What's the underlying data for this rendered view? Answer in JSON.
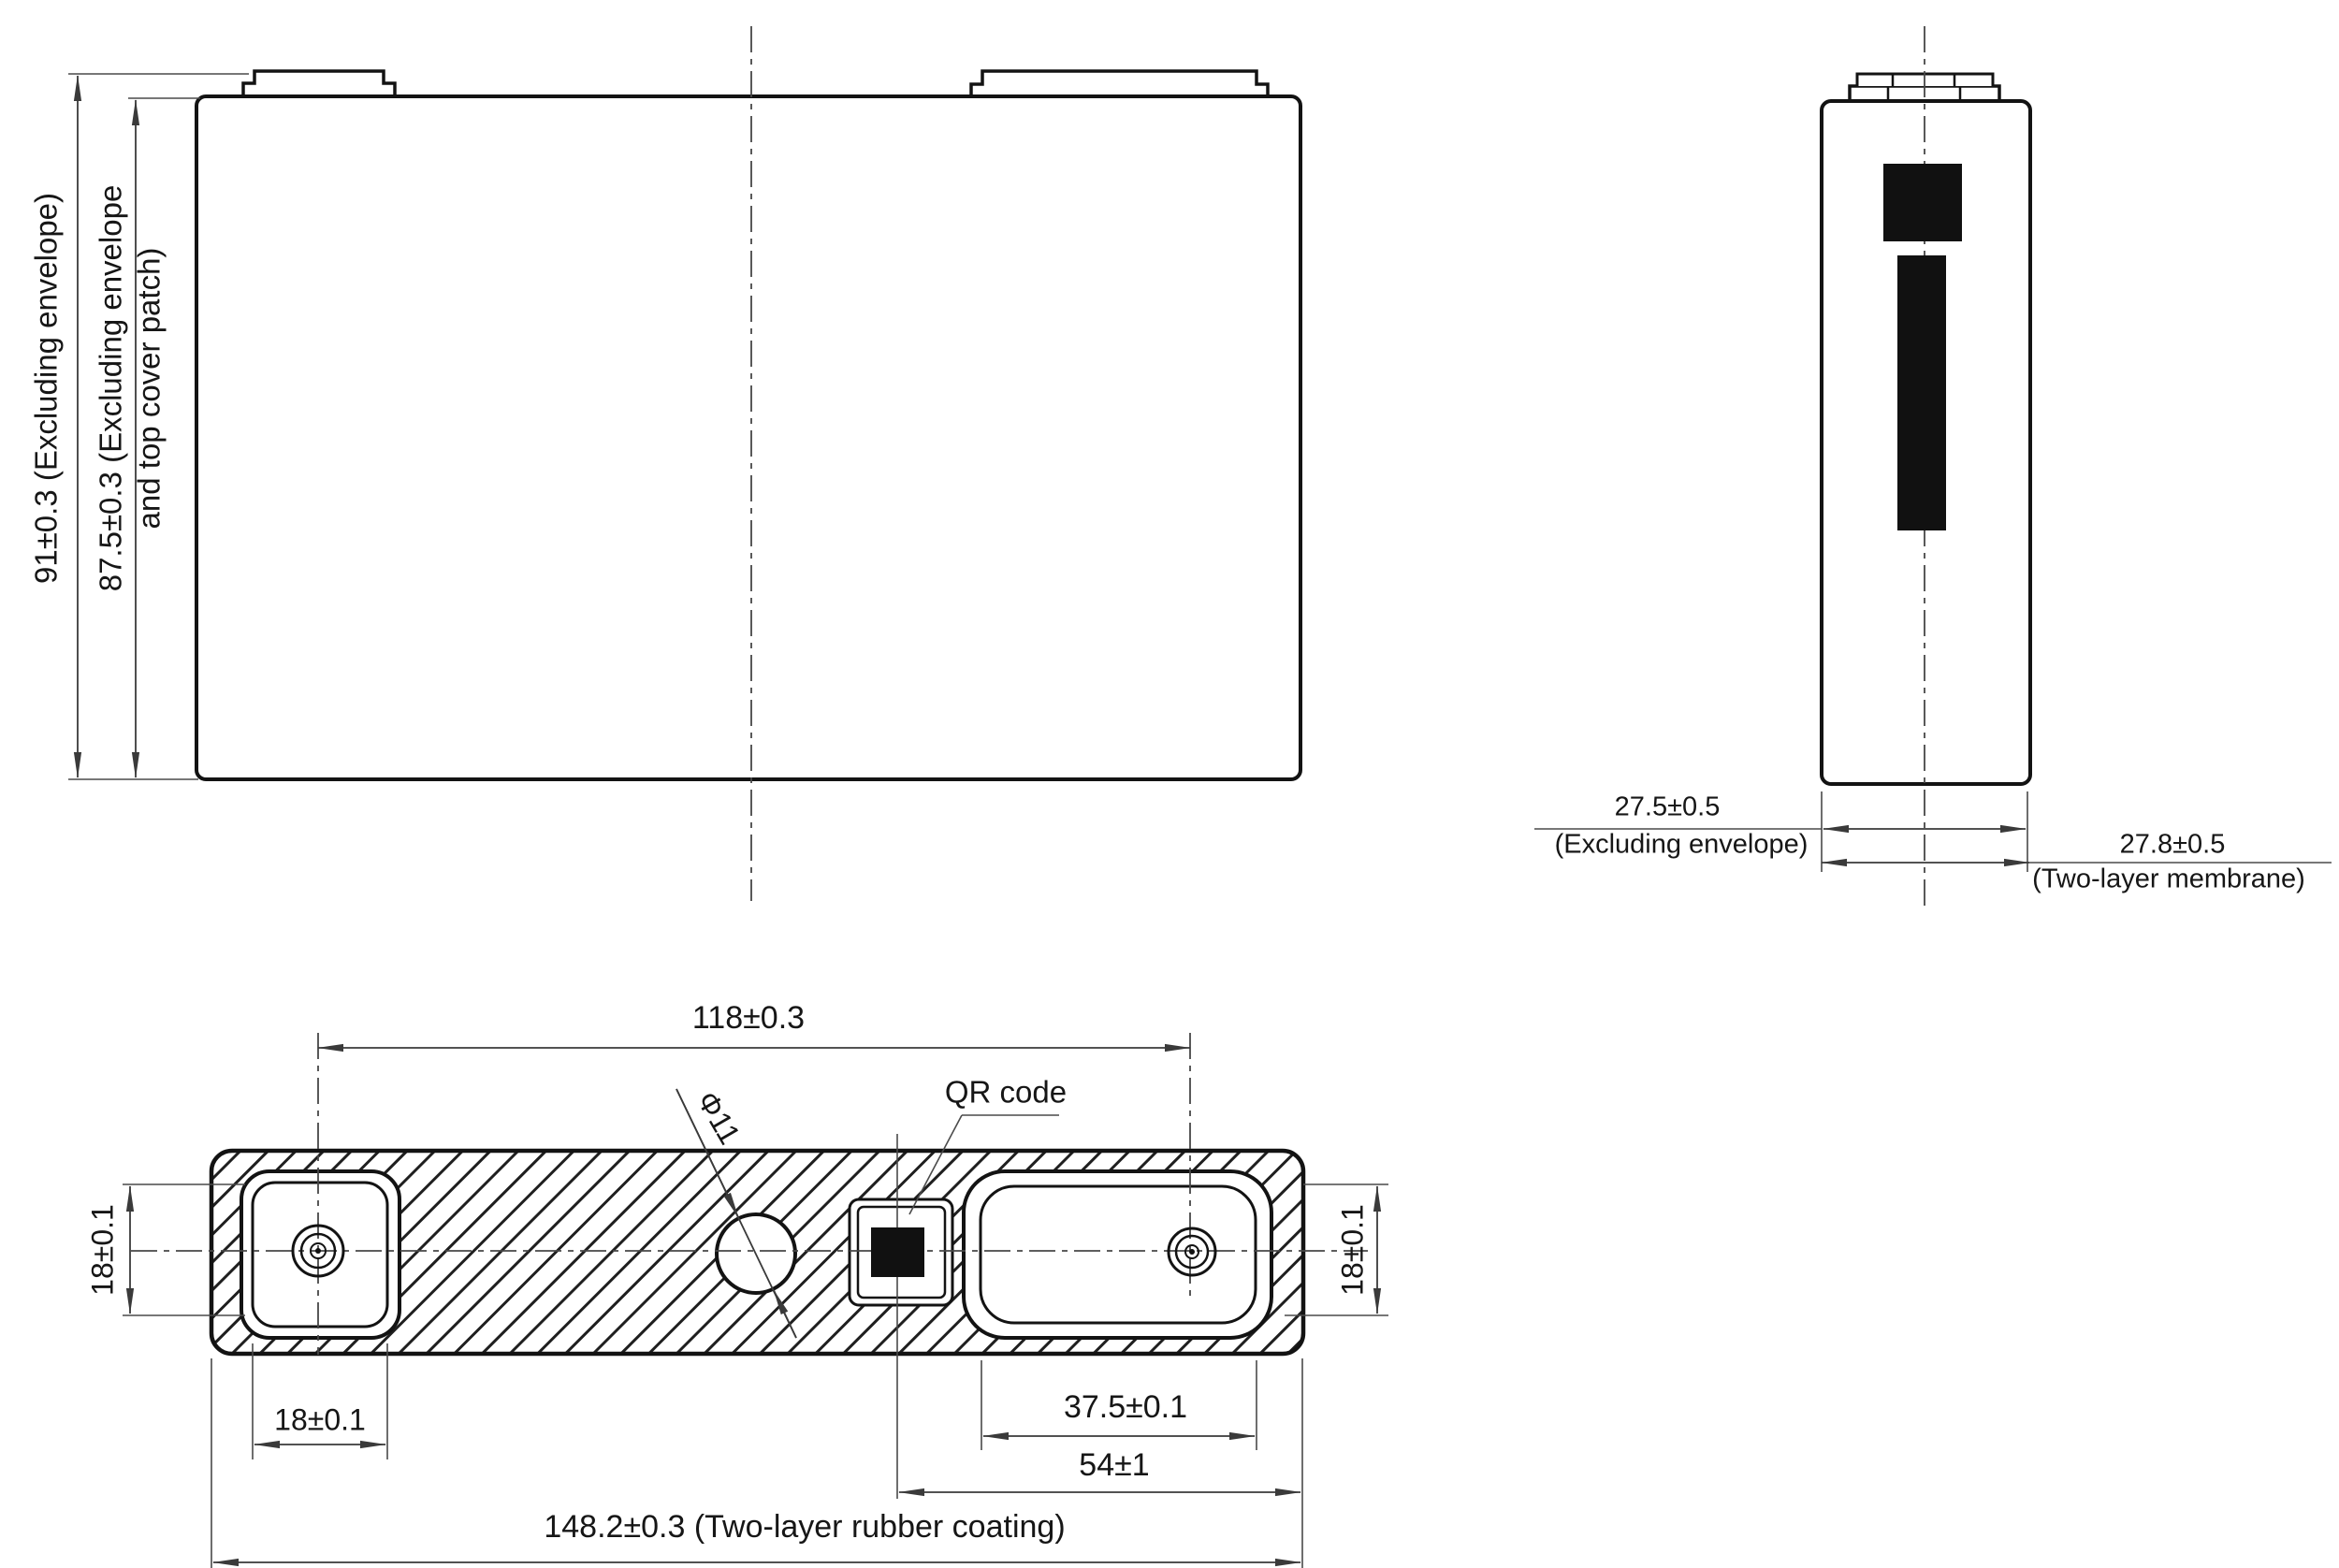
{
  "drawing": {
    "type": "battery-cell-engineering-drawing",
    "front_view": {
      "dim_height_outer": "91±0.3 (Excluding envelope)",
      "dim_height_inner_line1": "87.5±0.3 (Excluding envelope",
      "dim_height_inner_line2": "and top cover patch)"
    },
    "side_view": {
      "dim_thickness_value": "27.5±0.5",
      "dim_thickness_note": "(Excluding envelope)",
      "dim_membrane_value": "27.8±0.5",
      "dim_membrane_note": "(Two-layer membrane)"
    },
    "top_view": {
      "dim_terminal_pitch": "118±0.3",
      "vent_diameter_label": "Φ11",
      "qr_label": "QR code",
      "dim_terminal_height_left": "18±0.1",
      "dim_terminal_width_left": "18±0.1",
      "dim_terminal_height_right": "18±0.1",
      "dim_terminal_width_right": "37.5±0.1",
      "dim_qr_to_edge": "54±1",
      "dim_overall_length": "148.2±0.3 (Two-layer rubber coating)"
    },
    "colors": {
      "outline": "#131313",
      "dimension_line": "#3a3a3a",
      "centerline": "#4a4a4a",
      "solid_black": "#111111",
      "background": "#ffffff"
    }
  }
}
